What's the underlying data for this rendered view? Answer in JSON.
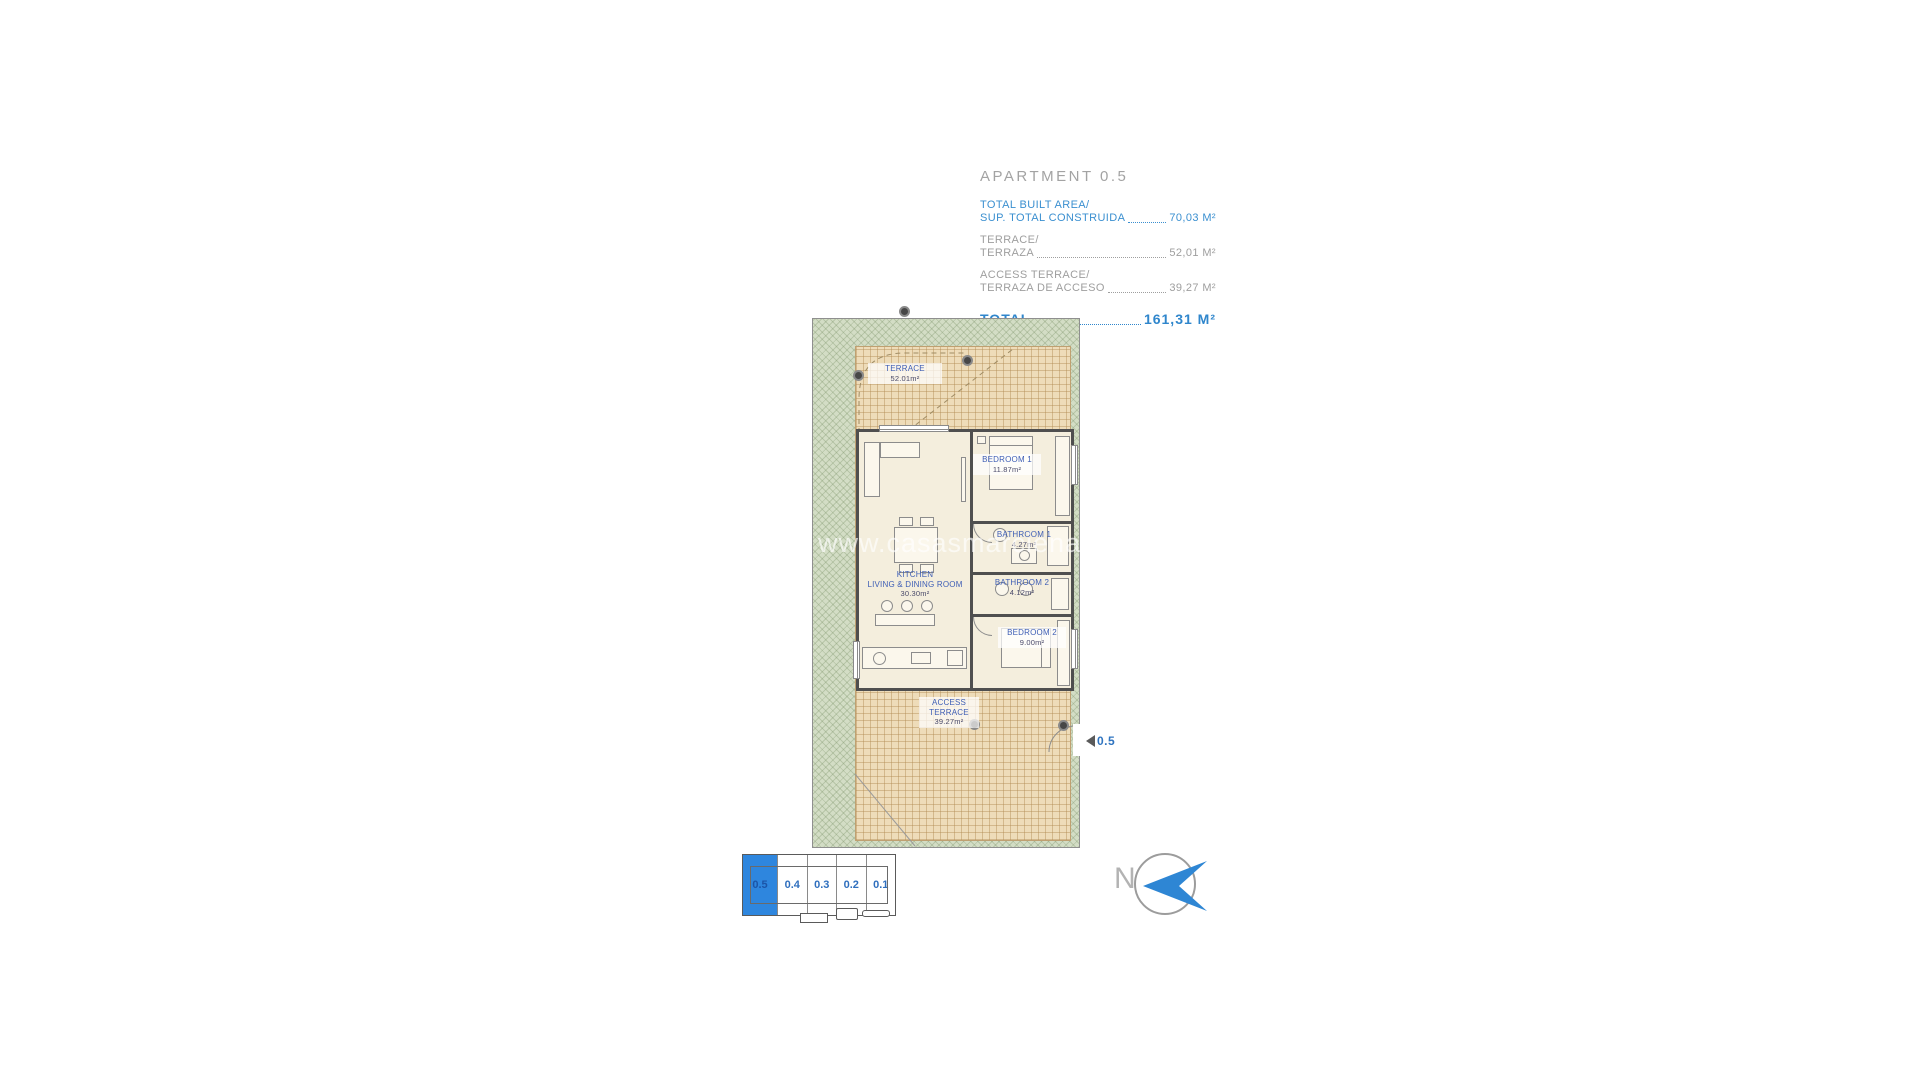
{
  "colors": {
    "accent_blue": "#2e86d4",
    "info_text_blue": "#3a8fd0",
    "info_text_gray": "#9e9e9e",
    "plan_label_blue": "#3e5eb5",
    "terrace_tan": "#eedcb9",
    "garden_green": "#d3ddc5",
    "wall_dark": "#4f4f4f",
    "selected_unit_blue": "#2e86de"
  },
  "info_panel": {
    "title": "APARTMENT 0.5",
    "rows": [
      {
        "label_en": "TOTAL BUILT AREA/",
        "label_es": "SUP. TOTAL CONSTRUIDA",
        "value": "70,03 M²"
      },
      {
        "label_en": "TERRACE/",
        "label_es": "TERRAZA",
        "value": "52,01 M²"
      },
      {
        "label_en": "ACCESS TERRACE/",
        "label_es": "TERRAZA DE ACCESO",
        "value": "39,27 M²"
      }
    ],
    "total_label": "TOTAL",
    "total_value": "161,31 M²"
  },
  "floor_plan": {
    "watermark": "www.casasmarciena.com",
    "terrace": {
      "name": "TERRACE",
      "area": "52.01m²"
    },
    "bedroom1": {
      "name": "BEDROOM 1",
      "area": "11.87m²"
    },
    "kitchen": {
      "line1": "KITCHEN",
      "line2": "LIVING & DINING ROOM",
      "area": "30.30m²"
    },
    "bathroom1": {
      "name": "BATHROOM 1",
      "area": "4.27m²"
    },
    "bathroom2": {
      "name": "BATHROOM 2",
      "area": "4.12m²"
    },
    "bedroom2": {
      "name": "BEDROOM 2",
      "area": "9.00m²"
    },
    "access_terrace": {
      "line1": "ACCESS",
      "line2": "TERRACE",
      "area": "39.27m²"
    },
    "entrance_label": "0.5"
  },
  "key_plan": {
    "units": [
      {
        "label": "0.5",
        "selected": true
      },
      {
        "label": "0.4",
        "selected": false
      },
      {
        "label": "0.3",
        "selected": false
      },
      {
        "label": "0.2",
        "selected": false
      },
      {
        "label": "0.1",
        "selected": false
      }
    ]
  },
  "compass": {
    "label": "N"
  }
}
